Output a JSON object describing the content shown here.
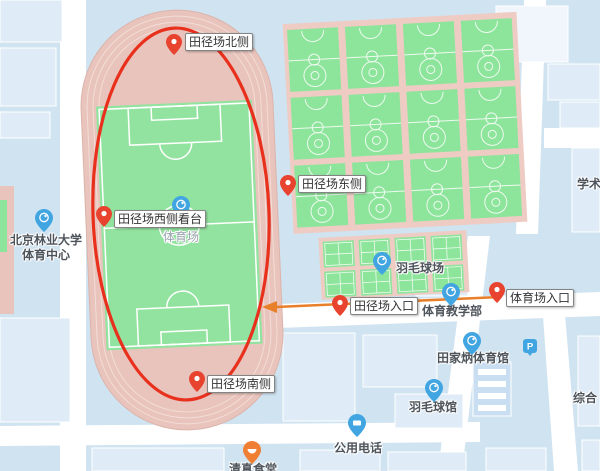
{
  "map_meta": {
    "type": "campus-map-screenshot",
    "annotation_ellipse_color": "#e8301d",
    "route_arrow_color": "#e87f2a",
    "pin_color": "#e8432e",
    "poi_icon_blue": "#41a5e1",
    "poi_icon_orange": "#f07f33",
    "background_color": "#cfe3f1",
    "track_color": "#e8c4bc",
    "field_color": "#93e3a0",
    "court_color": "#8de49b",
    "road_color": "#ffffff",
    "building_color": "#dfecf7"
  },
  "pin_labels": [
    {
      "text": "田径场北侧"
    },
    {
      "text": "田径场东侧"
    },
    {
      "text": "田径场西侧看台"
    },
    {
      "text": "田径场入口"
    },
    {
      "text": "体育场入口"
    },
    {
      "text": "田径场南侧"
    }
  ],
  "poi": {
    "badminton_courts": "羽毛球场",
    "pe_dept": "体育教学部",
    "gym": "田家炳体育馆",
    "badminton_hall": "羽毛球馆",
    "sports_center_line1": "北京林业大学",
    "sports_center_line2": "体育中心",
    "public_phone": "公用电话",
    "academic_partial": "学术",
    "complex_partial": "综合",
    "canteen_partial": "清真食堂",
    "stadium_ground": "体育场",
    "parking_letter": "P"
  }
}
